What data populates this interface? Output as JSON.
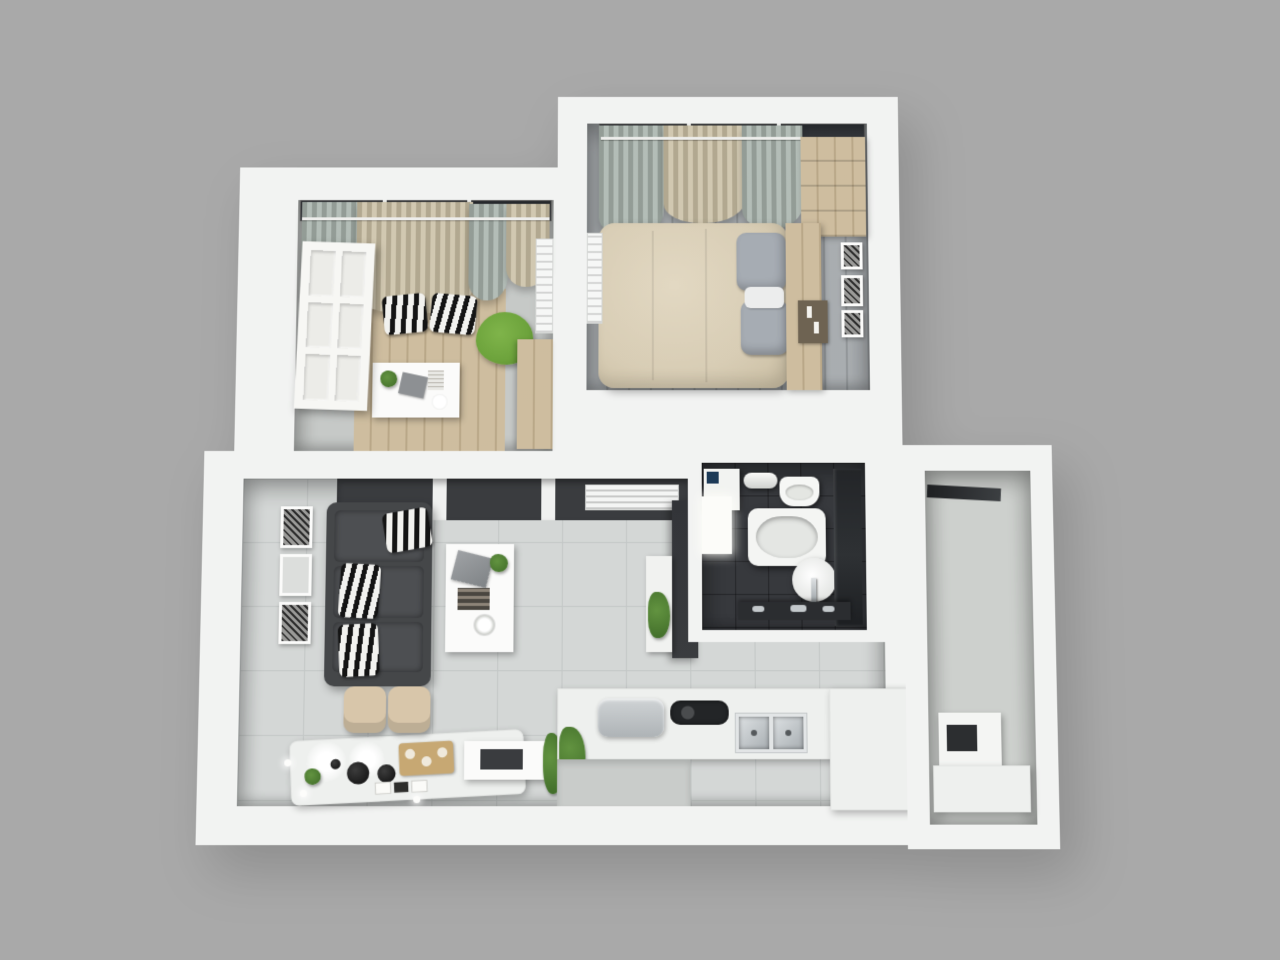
{
  "meta": {
    "kind": "3d-floorplan-render",
    "view": "top-down axonometric render of a one-bedroom apartment, no visible text",
    "canvas": {
      "width": 1280,
      "height": 960
    }
  },
  "colors": {
    "background": "#a9a9a9",
    "wall": "#f2f3f2",
    "office_floor": "#c6c9c7",
    "wood": "#c7b492",
    "bedroom_floor": "#9fa4a7",
    "tile_floor": "#d4d7d6",
    "tile_line": "#c3c7c6",
    "bath_floor": "#37393d",
    "dark_panel": "#3a3c3f",
    "sofa": "#454749",
    "green_chair": "#6da33c",
    "duvet": "#d8cdb5",
    "pillow_gray": "#a6acb3",
    "curtain_gray": "#a7b2ab",
    "curtain_beige": "#cabfa4",
    "counter": "#eef0ee",
    "gold": "#c7a873",
    "chair_beige": "#d8c6aa",
    "plant": "#3f6b28",
    "utility_floor": "#cdd0cd"
  },
  "rooms": [
    {
      "id": "home-office",
      "name": "home office",
      "items": [
        "open white six-panel door",
        "window with gray and beige curtains on a rail",
        "two zebra-print floor cushions",
        "green shell chair",
        "white desk with plant, gray mat, papers and round plate",
        "light wood area rug",
        "wall radiator",
        "wooden side cabinet"
      ]
    },
    {
      "id": "bedroom",
      "name": "bedroom",
      "items": [
        "double bed with beige duvet",
        "two gray pillows and white throw",
        "wooden headboard panel with candle tray",
        "stepped wooden wardrobe",
        "window with gray-green and beige curtains on a rail",
        "three picture frames on right wall",
        "wall radiator"
      ]
    },
    {
      "id": "living-room",
      "name": "living room",
      "items": [
        "charcoal sofa with three zebra-print pillows",
        "three framed artworks on left wall",
        "white coffee table with laptop, plant, magazine and plate",
        "dark sliding-door closet wall",
        "white louvered vent",
        "dark TV panel with white shelf and plant",
        "illuminated breakfast bar with bowls, plates, gold tray and plant",
        "two beige chairs",
        "white side table with dark tray",
        "tall potted plant",
        "small sphere floor lights"
      ]
    },
    {
      "id": "kitchen",
      "name": "kitchen",
      "items": [
        "white L-shaped counter",
        "double stainless-steel sink with faucet",
        "dark built-in cooktop",
        "gray countertop appliance",
        "potted plant in white planter",
        "gray entrance step"
      ]
    },
    {
      "id": "bathroom",
      "name": "bathroom",
      "items": [
        "dark mosaic tile floor",
        "washing machine with dark control panel",
        "rolled towel on shelf",
        "toilet",
        "bathtub",
        "round washbasin with chrome faucet",
        "dark glass shower screen",
        "bright white door",
        "dark vanity ledge with chrome taps"
      ]
    },
    {
      "id": "utility-room",
      "name": "utility room",
      "items": [
        "dark ceiling rail",
        "white appliance with dark door",
        "white counter top"
      ]
    }
  ]
}
